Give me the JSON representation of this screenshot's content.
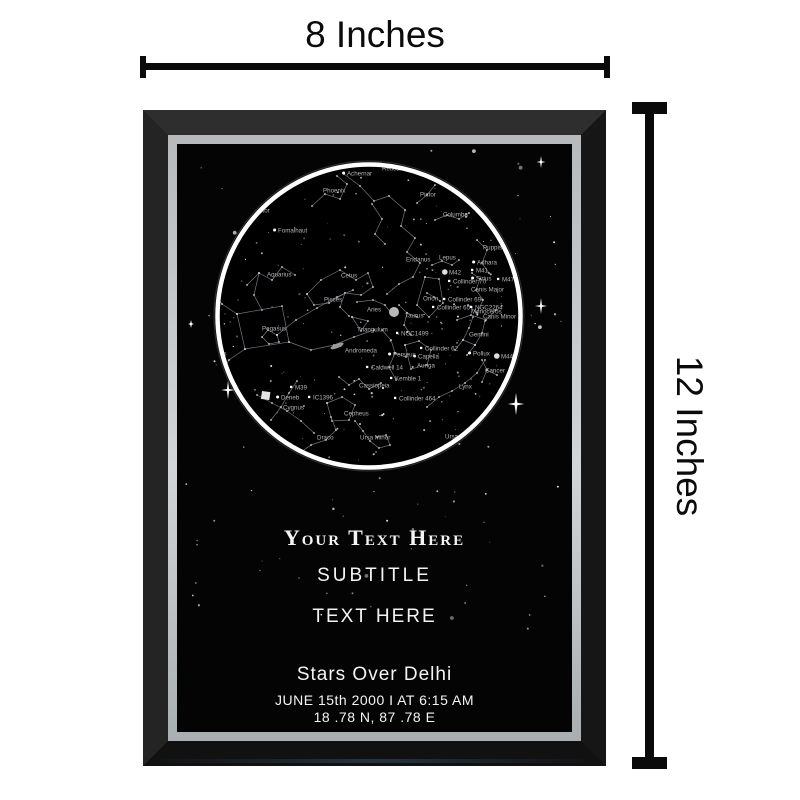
{
  "measurements": {
    "width": "8 Inches",
    "height": "12 Inches"
  },
  "poster": {
    "title": "Your Text Here",
    "subtitle": "SUBTITLE",
    "text_line": "TEXT HERE",
    "location": "Stars Over Delhi",
    "datetime": "JUNE 15th 2000  I  AT 6:15 AM",
    "coordinates": "18 .78 N, 87 .78 E"
  },
  "colors": {
    "background": "#ffffff",
    "ruler": "#0a0a0a",
    "frame_black": "#1d1d1d",
    "fillet_silver": "#c6cacc",
    "poster_bg": "#040404",
    "ring": "#ffffff",
    "label_text": "#b4b4b4",
    "line": "#8d939a"
  },
  "star_map": {
    "circle": {
      "cx": 192,
      "cy": 172,
      "r": 150,
      "ring_r": 151.5
    },
    "starfield": {
      "seed": 12,
      "outer_count": 110,
      "inner_count": 155
    },
    "sparkles": [
      {
        "x": 51,
        "y": 246,
        "s": 9
      },
      {
        "x": 364,
        "y": 18,
        "s": 6
      },
      {
        "x": 364,
        "y": 162,
        "s": 8
      },
      {
        "x": 339,
        "y": 260,
        "s": 11
      },
      {
        "x": 14,
        "y": 180,
        "s": 4
      }
    ],
    "blobs": {
      "moon": {
        "x": 217,
        "y": 168,
        "r": 5
      },
      "galaxy": {
        "x": 160,
        "y": 202
      },
      "patch": {
        "x": 85,
        "y": 247
      }
    },
    "labels": [
      {
        "t": "Achernar",
        "x": 170,
        "y": 29,
        "m": "dot"
      },
      {
        "t": "Reticulum",
        "x": 205,
        "y": 24
      },
      {
        "t": "Phoenix",
        "x": 146,
        "y": 46
      },
      {
        "t": "Pictor",
        "x": 243,
        "y": 50
      },
      {
        "t": "Columba",
        "x": 266,
        "y": 70
      },
      {
        "t": "Sculptor",
        "x": 70,
        "y": 66
      },
      {
        "t": "Fomalhaut",
        "x": 101,
        "y": 86,
        "m": "dot"
      },
      {
        "t": "Puppis",
        "x": 306,
        "y": 103
      },
      {
        "t": "Adhara",
        "x": 300,
        "y": 118,
        "m": "dot"
      },
      {
        "t": "M41",
        "x": 299,
        "y": 126,
        "m": "sq"
      },
      {
        "t": "Sirius",
        "x": 299,
        "y": 134,
        "m": "dot"
      },
      {
        "t": "Canis Major",
        "x": 294,
        "y": 145
      },
      {
        "t": "M47",
        "x": 325,
        "y": 135,
        "m": "sq"
      },
      {
        "t": "Aquarius",
        "x": 90,
        "y": 130
      },
      {
        "t": "Cetus",
        "x": 164,
        "y": 131
      },
      {
        "t": "Eridanus",
        "x": 229,
        "y": 115
      },
      {
        "t": "Lepus",
        "x": 262,
        "y": 113
      },
      {
        "t": "M42",
        "x": 272,
        "y": 128,
        "m": "big"
      },
      {
        "t": "Collinder 70",
        "x": 276,
        "y": 137,
        "m": "sq"
      },
      {
        "t": "Monoceros",
        "x": 294,
        "y": 167
      },
      {
        "t": "Orion",
        "x": 246,
        "y": 154
      },
      {
        "t": "Collinder 69",
        "x": 271,
        "y": 155,
        "m": "sq"
      },
      {
        "t": "Collinder 65",
        "x": 260,
        "y": 163,
        "m": "sq"
      },
      {
        "t": "NGC2264",
        "x": 298,
        "y": 163,
        "m": "sq"
      },
      {
        "t": "Canis Minor",
        "x": 306,
        "y": 172
      },
      {
        "t": "Taurus",
        "x": 228,
        "y": 171
      },
      {
        "t": "NGC1499",
        "x": 224,
        "y": 189,
        "m": "sq"
      },
      {
        "t": "Gemini",
        "x": 292,
        "y": 190
      },
      {
        "t": "Collinder 62",
        "x": 248,
        "y": 204,
        "m": "sq"
      },
      {
        "t": "Capella",
        "x": 241,
        "y": 212,
        "m": "dot"
      },
      {
        "t": "Auriga",
        "x": 240,
        "y": 221
      },
      {
        "t": "Pollux",
        "x": 296,
        "y": 209,
        "m": "dot"
      },
      {
        "t": "M44",
        "x": 324,
        "y": 212,
        "m": "big"
      },
      {
        "t": "Cancer",
        "x": 308,
        "y": 226
      },
      {
        "t": "Lynx",
        "x": 282,
        "y": 242
      },
      {
        "t": "Pisces",
        "x": 147,
        "y": 155
      },
      {
        "t": "Aries",
        "x": 190,
        "y": 165
      },
      {
        "t": "Pegasus",
        "x": 85,
        "y": 184
      },
      {
        "t": "Triangulum",
        "x": 180,
        "y": 185
      },
      {
        "t": "Andromeda",
        "x": 168,
        "y": 206
      },
      {
        "t": "Perseus",
        "x": 216,
        "y": 210,
        "m": "dot"
      },
      {
        "t": "Caldwell 14",
        "x": 194,
        "y": 223,
        "m": "sq"
      },
      {
        "t": "Cassiopeia",
        "x": 182,
        "y": 241
      },
      {
        "t": "Kemble 1",
        "x": 218,
        "y": 234,
        "m": "sq"
      },
      {
        "t": "M39",
        "x": 118,
        "y": 243,
        "m": "sq"
      },
      {
        "t": "Deneb",
        "x": 104,
        "y": 253,
        "m": "dot"
      },
      {
        "t": "Cygnus",
        "x": 106,
        "y": 263
      },
      {
        "t": "IC1396",
        "x": 136,
        "y": 253,
        "m": "sq"
      },
      {
        "t": "Cepheus",
        "x": 167,
        "y": 269
      },
      {
        "t": "Collinder 464",
        "x": 222,
        "y": 254,
        "m": "sq"
      },
      {
        "t": "Draco",
        "x": 140,
        "y": 293
      },
      {
        "t": "Ursa Minor",
        "x": 183,
        "y": 293
      },
      {
        "t": "Ursa Major",
        "x": 268,
        "y": 292
      },
      {
        "t": "Delphinus",
        "x": 22,
        "y": 209
      }
    ],
    "lines": [
      [
        [
          135,
          62
        ],
        [
          148,
          50
        ],
        [
          163,
          55
        ],
        [
          170,
          40
        ],
        [
          160,
          32
        ]
      ],
      [
        [
          167,
          30
        ],
        [
          183,
          42
        ],
        [
          197,
          57
        ],
        [
          212,
          52
        ],
        [
          228,
          66
        ],
        [
          224,
          82
        ],
        [
          238,
          94
        ],
        [
          230,
          108
        ],
        [
          243,
          119
        ],
        [
          236,
          133
        ],
        [
          222,
          140
        ],
        [
          210,
          150
        ]
      ],
      [
        [
          130,
          150
        ],
        [
          144,
          136
        ],
        [
          163,
          126
        ],
        [
          179,
          136
        ],
        [
          191,
          129
        ],
        [
          196,
          143
        ],
        [
          184,
          151
        ],
        [
          168,
          149
        ],
        [
          152,
          159
        ],
        [
          137,
          161
        ],
        [
          130,
          150
        ]
      ],
      [
        [
          168,
          149
        ],
        [
          163,
          163
        ],
        [
          172,
          172
        ]
      ],
      [
        [
          70,
          141
        ],
        [
          82,
          129
        ],
        [
          95,
          136
        ],
        [
          105,
          123
        ],
        [
          118,
          131
        ]
      ],
      [
        [
          82,
          129
        ],
        [
          77,
          151
        ],
        [
          85,
          166
        ]
      ],
      [
        [
          100,
          191
        ],
        [
          119,
          176
        ],
        [
          140,
          164
        ],
        [
          160,
          153
        ],
        [
          176,
          146
        ]
      ],
      [
        [
          100,
          191
        ],
        [
          91,
          186
        ],
        [
          85,
          193
        ],
        [
          92,
          200
        ],
        [
          102,
          198
        ],
        [
          100,
          191
        ]
      ],
      [
        [
          60,
          170
        ],
        [
          105,
          162
        ],
        [
          112,
          198
        ],
        [
          68,
          205
        ],
        [
          60,
          170
        ]
      ],
      [
        [
          60,
          170
        ],
        [
          45,
          160
        ],
        [
          37,
          149
        ]
      ],
      [
        [
          68,
          205
        ],
        [
          52,
          216
        ],
        [
          44,
          228
        ]
      ],
      [
        [
          112,
          198
        ],
        [
          134,
          206
        ],
        [
          157,
          201
        ],
        [
          177,
          193
        ],
        [
          197,
          186
        ]
      ],
      [
        [
          175,
          173
        ],
        [
          191,
          177
        ],
        [
          184,
          187
        ],
        [
          175,
          173
        ]
      ],
      [
        [
          180,
          158
        ],
        [
          196,
          156
        ],
        [
          208,
          161
        ],
        [
          214,
          169
        ]
      ],
      [
        [
          205,
          186
        ],
        [
          214,
          196
        ],
        [
          218,
          209
        ],
        [
          212,
          223
        ],
        [
          219,
          236
        ]
      ],
      [
        [
          218,
          209
        ],
        [
          229,
          213
        ]
      ],
      [
        [
          162,
          233
        ],
        [
          172,
          241
        ],
        [
          182,
          235
        ],
        [
          192,
          245
        ],
        [
          204,
          239
        ]
      ],
      [
        [
          150,
          259
        ],
        [
          165,
          253
        ],
        [
          178,
          261
        ],
        [
          172,
          276
        ],
        [
          155,
          277
        ],
        [
          150,
          259
        ]
      ],
      [
        [
          80,
          251
        ],
        [
          95,
          259
        ],
        [
          110,
          267
        ],
        [
          124,
          277
        ],
        [
          137,
          289
        ]
      ],
      [
        [
          94,
          276
        ],
        [
          104,
          263
        ],
        [
          112,
          249
        ],
        [
          120,
          237
        ]
      ],
      [
        [
          120,
          311
        ],
        [
          134,
          301
        ],
        [
          149,
          296
        ],
        [
          159,
          286
        ],
        [
          154,
          273
        ]
      ],
      [
        [
          120,
          311
        ],
        [
          112,
          319
        ],
        [
          118,
          326
        ],
        [
          128,
          321
        ]
      ],
      [
        [
          178,
          277
        ],
        [
          186,
          287
        ],
        [
          193,
          297
        ],
        [
          202,
          304
        ],
        [
          213,
          301
        ],
        [
          209,
          291
        ],
        [
          200,
          293
        ]
      ],
      [
        [
          255,
          311
        ],
        [
          268,
          301
        ],
        [
          282,
          303
        ],
        [
          290,
          313
        ],
        [
          278,
          323
        ],
        [
          263,
          321
        ],
        [
          255,
          311
        ]
      ],
      [
        [
          290,
          313
        ],
        [
          302,
          306
        ],
        [
          312,
          300
        ]
      ],
      [
        [
          250,
          263
        ],
        [
          262,
          253
        ],
        [
          275,
          247
        ],
        [
          288,
          239
        ],
        [
          300,
          229
        ],
        [
          308,
          216
        ]
      ],
      [
        [
          228,
          201
        ],
        [
          242,
          197
        ],
        [
          254,
          206
        ],
        [
          250,
          221
        ],
        [
          234,
          225
        ],
        [
          228,
          201
        ]
      ],
      [
        [
          222,
          161
        ],
        [
          230,
          169
        ],
        [
          240,
          173
        ]
      ],
      [
        [
          230,
          169
        ],
        [
          227,
          181
        ],
        [
          234,
          191
        ]
      ],
      [
        [
          248,
          133
        ],
        [
          262,
          135
        ],
        [
          266,
          159
        ],
        [
          252,
          173
        ],
        [
          240,
          161
        ],
        [
          248,
          133
        ]
      ],
      [
        [
          250,
          149
        ],
        [
          257,
          153
        ],
        [
          263,
          157
        ]
      ],
      [
        [
          255,
          121
        ],
        [
          265,
          117
        ],
        [
          275,
          121
        ],
        [
          282,
          116
        ]
      ],
      [
        [
          295,
          129
        ],
        [
          303,
          135
        ],
        [
          299,
          146
        ],
        [
          306,
          156
        ],
        [
          300,
          169
        ],
        [
          291,
          161
        ]
      ],
      [
        [
          280,
          176
        ],
        [
          294,
          171
        ],
        [
          309,
          176
        ],
        [
          319,
          166
        ]
      ],
      [
        [
          278,
          206
        ],
        [
          286,
          196
        ],
        [
          292,
          184
        ],
        [
          296,
          173
        ]
      ],
      [
        [
          290,
          211
        ],
        [
          298,
          201
        ],
        [
          305,
          189
        ],
        [
          308,
          177
        ]
      ],
      [
        [
          286,
          196
        ],
        [
          298,
          201
        ]
      ],
      [
        [
          305,
          216
        ],
        [
          310,
          226
        ],
        [
          305,
          238
        ]
      ],
      [
        [
          310,
          226
        ],
        [
          320,
          231
        ]
      ],
      [
        [
          258,
          76
        ],
        [
          270,
          71
        ],
        [
          282,
          75
        ],
        [
          292,
          69
        ]
      ],
      [
        [
          240,
          59
        ],
        [
          250,
          51
        ],
        [
          258,
          41
        ]
      ],
      [
        [
          300,
          96
        ],
        [
          310,
          106
        ],
        [
          305,
          119
        ],
        [
          312,
          129
        ]
      ],
      [
        [
          195,
          60
        ],
        [
          205,
          75
        ],
        [
          198,
          90
        ],
        [
          208,
          100
        ]
      ]
    ]
  }
}
